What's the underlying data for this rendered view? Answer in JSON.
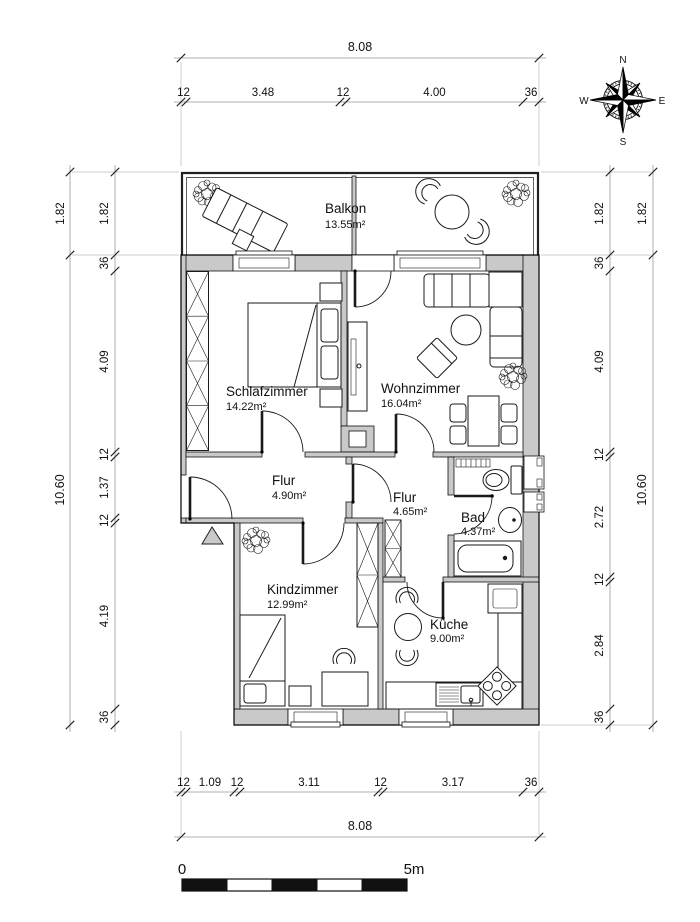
{
  "rooms": [
    {
      "name": "Balkon",
      "area": "13.55m²"
    },
    {
      "name": "Schlafzimmer",
      "area": "14.22m²"
    },
    {
      "name": "Wohnzimmer",
      "area": "16.04m²"
    },
    {
      "name": "Flur",
      "area": "4.90m²"
    },
    {
      "name": "Flur",
      "area": "4.65m²"
    },
    {
      "name": "Bad",
      "area": "4.37m²"
    },
    {
      "name": "Kindzimmer",
      "area": "12.99m²"
    },
    {
      "name": "Küche",
      "area": "9.00m²"
    }
  ],
  "dimensions": {
    "top": {
      "overall": "8.08",
      "segments": [
        "12",
        "3.48",
        "12",
        "4.00",
        "36"
      ]
    },
    "bottom": {
      "overall": "8.08",
      "segments": [
        "12",
        "1.09",
        "12",
        "3.11",
        "12",
        "3.17",
        "36"
      ]
    },
    "left": {
      "outer": [
        "1.82",
        "10.60"
      ],
      "inner": [
        "1.82",
        "36",
        "4.09",
        "12",
        "1.37",
        "12",
        "4.19",
        "36"
      ]
    },
    "right": {
      "outer": [
        "1.82",
        "10.60"
      ],
      "inner": [
        "1.82",
        "36",
        "4.09",
        "12",
        "2.72",
        "12",
        "2.84",
        "36"
      ]
    }
  },
  "compass": {
    "north": "N",
    "east": "E",
    "south": "S",
    "west": "W"
  },
  "scale_bar": {
    "start": "0",
    "end": "5m"
  },
  "colors": {
    "wall_fill": "#c9c9c9",
    "line": "#1a1a1a",
    "dimension_line": "#999999"
  }
}
